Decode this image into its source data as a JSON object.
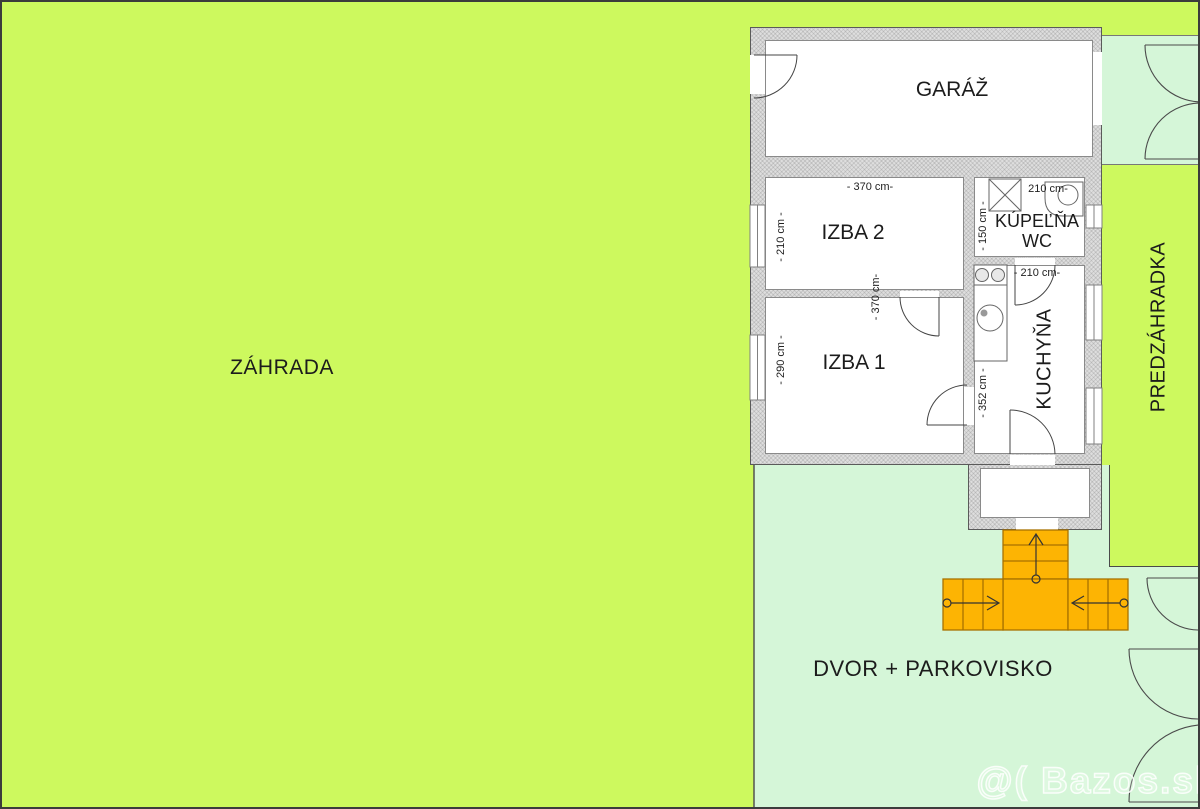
{
  "areas": {
    "zahrada": {
      "label": "ZÁHRADA"
    },
    "predzahradka": {
      "label": "PREDZÁHRADKA"
    },
    "dvor_parkovisko": {
      "label": "DVOR + PARKOVISKO"
    }
  },
  "rooms": {
    "garaz": {
      "label": "GARÁŽ"
    },
    "izba2": {
      "label": "IZBA 2",
      "dim_width": "- 370 cm-",
      "dim_height": "- 210 cm -"
    },
    "izba1": {
      "label": "IZBA 1",
      "dim_height": "- 290 cm -"
    },
    "stredna_stena": {
      "dim_height": "- 370 cm-"
    },
    "kupelna": {
      "label": "KÚPEĽŇA",
      "label2": "WC",
      "dim_width": "210 cm-",
      "dim_height": "- 150 cm -"
    },
    "kuchyna": {
      "label": "KUCHYŇA",
      "dim_width": "- 210 cm-",
      "dim_height": "- 352 cm -"
    }
  },
  "watermark": "@( Bazos.sk",
  "colors": {
    "grass": "#cdf95e",
    "paving": "#d5f6d8",
    "wall_fill": "#dedede",
    "stairs_fill": "#fdb403",
    "stairs_stroke": "#a87200",
    "outline": "#4a4a4a"
  }
}
